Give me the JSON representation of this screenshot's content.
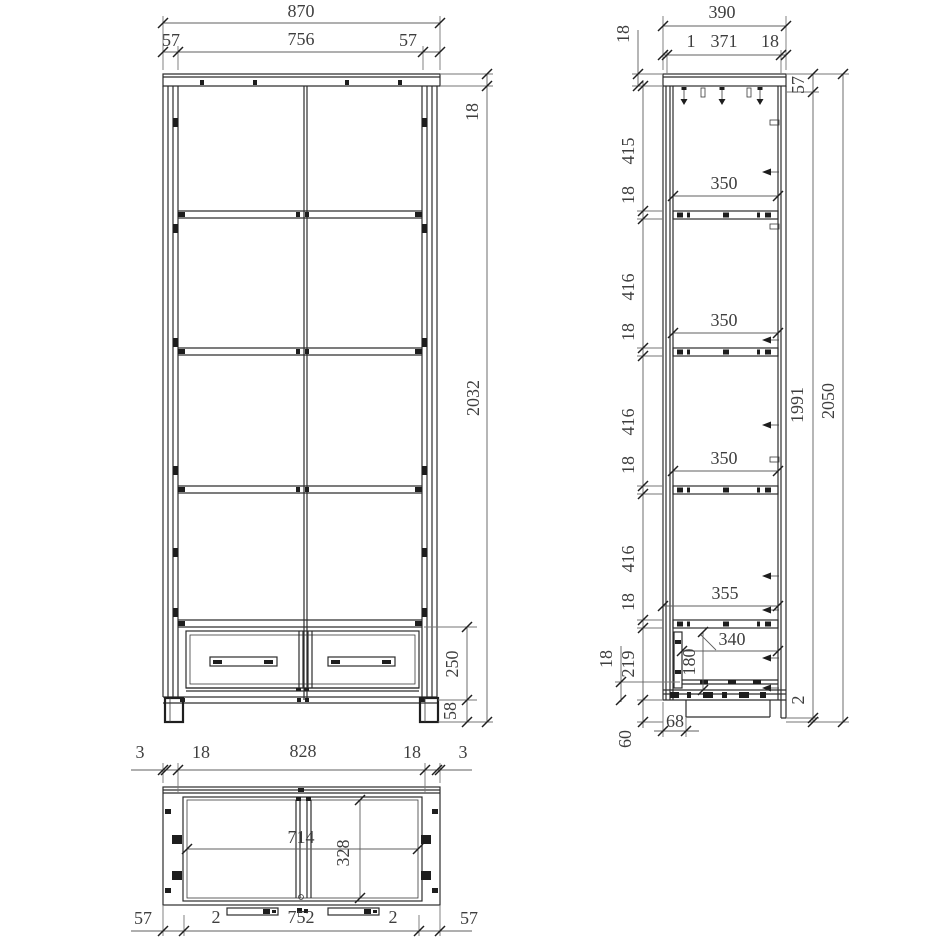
{
  "drawing": {
    "description": "furniture technical drawing, three orthographic views of a tall cabinet with shelves and drawers",
    "colors": {
      "line": "#2d2d2d",
      "dimension_line": "#767676",
      "text": "#3e3e3e",
      "background": "#ffffff"
    },
    "front": {
      "top": {
        "overall": "870",
        "left": "57",
        "mid": "756",
        "right": "57"
      },
      "right": {
        "panel": "18",
        "body": "2032",
        "drawer": "250",
        "plinth": "58"
      }
    },
    "side": {
      "top": {
        "overall": "390",
        "gap": "1",
        "inner": "371",
        "back": "18",
        "panel": "18"
      },
      "left": {
        "s1": "415",
        "t1": "18",
        "s2": "416",
        "t2": "18",
        "s3": "416",
        "t3": "18",
        "s4": "416",
        "t4": "18",
        "drawer": "219",
        "rail": "18",
        "plinth": "60",
        "inset": "68"
      },
      "inner": {
        "shelf1": "350",
        "shelf2": "350",
        "shelf3": "350",
        "bottom_shelf": "355",
        "drawer_depth": "340",
        "drawer_front": "180"
      },
      "right": {
        "rail": "57",
        "body": "1991",
        "gap": "2",
        "overall": "2050"
      }
    },
    "plan": {
      "top": {
        "a3": "3",
        "a18": "18",
        "mid": "828",
        "b18": "18",
        "b3": "3"
      },
      "inner": {
        "width": "714",
        "depth": "328"
      },
      "bottom": {
        "a57": "57",
        "a2": "2",
        "mid": "752",
        "b2": "2",
        "b57": "57"
      }
    }
  }
}
